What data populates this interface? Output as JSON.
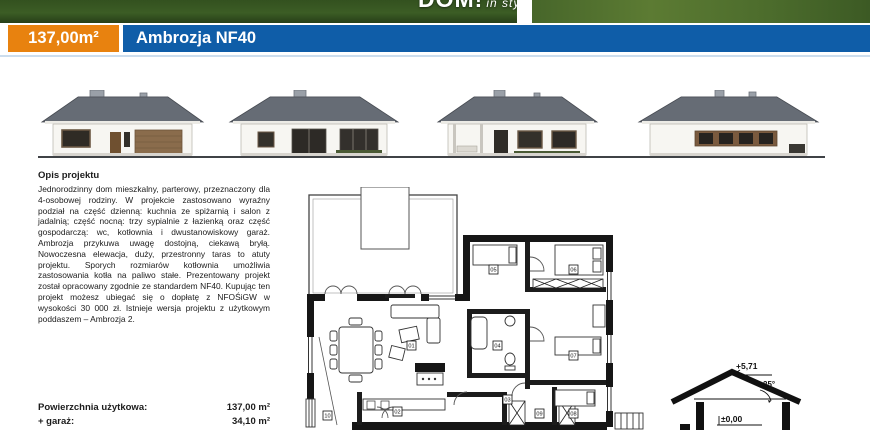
{
  "header": {
    "area_badge": "137,00m²",
    "title": "Ambrozja NF40",
    "logo_main": "DOM!",
    "logo_sub": "in style"
  },
  "description": {
    "heading": "Opis projektu",
    "body": "Jednorodzinny dom mieszkalny, parterowy, przeznaczony dla 4-osobowej rodziny. W projekcie zastosowano wyraźny podział na część dzienną: kuchnia ze spiżarnią i salon z jadalnią; część nocną: trzy sypialnie z łazienką oraz część gospodarczą: wc, kotłownia i dwustanowiskowy garaż. Ambrozja przykuwa uwagę dostojną, ciekawą bryłą. Nowoczesna elewacja, duży, przestronny taras to atuty projektu. Sporych rozmiarów kotłownia umożliwia zastosowania kotła na paliwo stałe. Prezentowany projekt został opracowany zgodnie ze standardem NF40. Kupując ten projekt możesz ubiegać się o dopłatę z NFOŚiGW w wysokości 30 000 zł. Istnieje wersja projektu z użytkowym poddaszem – Ambrozja 2."
  },
  "areas": {
    "usable_label": "Powierzchnia użytkowa:",
    "usable_value": "137,00 m²",
    "garage_label": "+ garaż:",
    "garage_value": "34,10 m²"
  },
  "section_drawing": {
    "ridge_height": "+5,71",
    "roof_angle": "25°",
    "floor_level": "±0,00"
  },
  "floor_plan": {
    "rooms": [
      "01",
      "02",
      "03",
      "04",
      "05",
      "06",
      "07",
      "08",
      "09",
      "10"
    ]
  },
  "colors": {
    "accent_orange": "#e8820f",
    "accent_blue": "#0f5da8",
    "rule_blue": "#ccdded",
    "roof": "#666c75",
    "ground": "#3f4246"
  }
}
